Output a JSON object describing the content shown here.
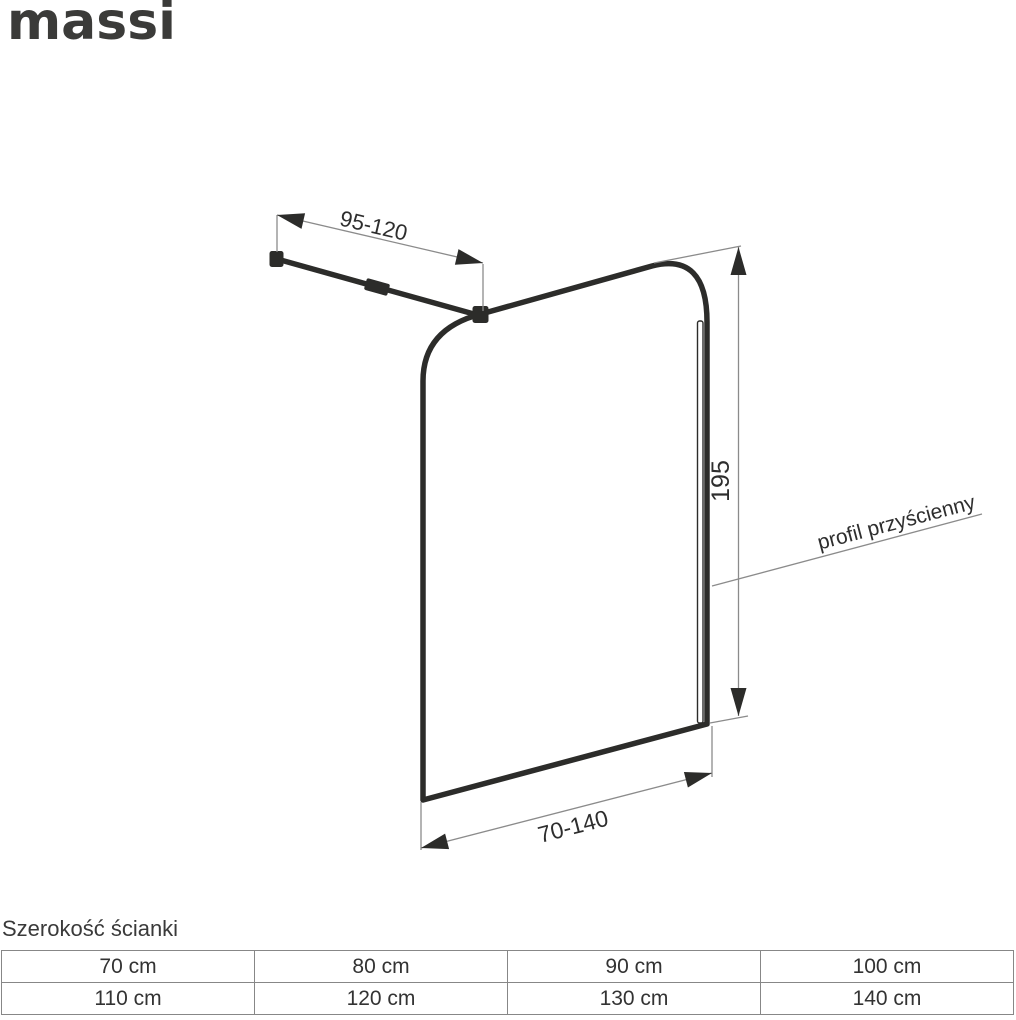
{
  "brand": {
    "logo_text": "massi"
  },
  "diagram": {
    "labels": {
      "bar_length_range": "95-120",
      "panel_height": "195",
      "panel_width_range": "70-140",
      "wall_profile": "profil przyścienny"
    }
  },
  "width_table": {
    "title": "Szerokość ścianki",
    "rows": [
      [
        "70 cm",
        "80 cm",
        "90 cm",
        "100 cm"
      ],
      [
        "110 cm",
        "120 cm",
        "130 cm",
        "140 cm"
      ]
    ]
  },
  "colors": {
    "outline": "#2c2c2a",
    "dimension_line": "#8b8b8b",
    "text": "#2e2e2e",
    "table_border": "#878787"
  }
}
